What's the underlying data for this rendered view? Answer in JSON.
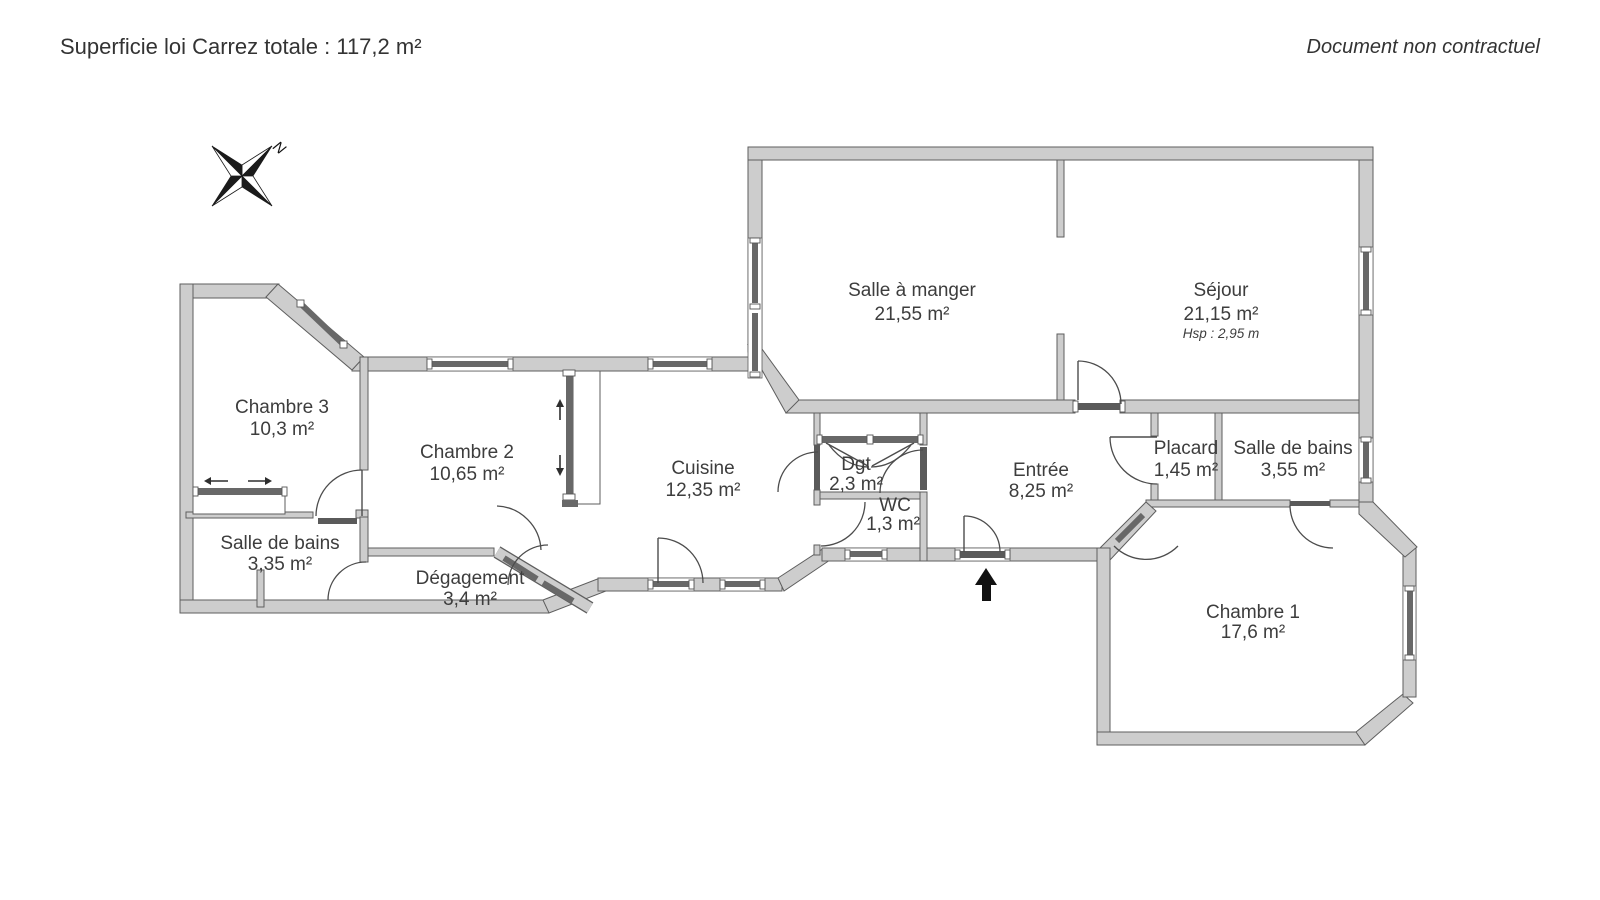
{
  "header": {
    "left": "Superficie loi Carrez totale : 117,2 m²",
    "right": "Document non contractuel"
  },
  "compass": {
    "label": "N"
  },
  "rooms": {
    "salle_a_manger": {
      "name": "Salle à manger",
      "area": "21,55 m²"
    },
    "sejour": {
      "name": "Séjour",
      "area": "21,15 m²",
      "ceiling": "Hsp : 2,95 m"
    },
    "chambre3": {
      "name": "Chambre 3",
      "area": "10,3 m²"
    },
    "chambre2": {
      "name": "Chambre 2",
      "area": "10,65 m²"
    },
    "sdb_gauche": {
      "name": "Salle de bains",
      "area": "3,35 m²"
    },
    "degagement": {
      "name": "Dégagement",
      "area": "3,4 m²"
    },
    "cuisine": {
      "name": "Cuisine",
      "area": "12,35 m²"
    },
    "dgt": {
      "name": "Dgt",
      "area": "2,3 m²"
    },
    "wc": {
      "name": "WC",
      "area": "1,3 m²"
    },
    "entree": {
      "name": "Entrée",
      "area": "8,25 m²"
    },
    "placard": {
      "name": "Placard",
      "area": "1,45 m²"
    },
    "sdb_droite": {
      "name": "Salle de bains",
      "area": "3,55 m²"
    },
    "chambre1": {
      "name": "Chambre 1",
      "area": "17,6 m²"
    }
  },
  "colors": {
    "wall_fill": "#cdcdcd",
    "wall_stroke": "#5e5e5e",
    "window_band": "#686868",
    "text": "#3d3d3d",
    "entrance_arrow": "#111111"
  }
}
